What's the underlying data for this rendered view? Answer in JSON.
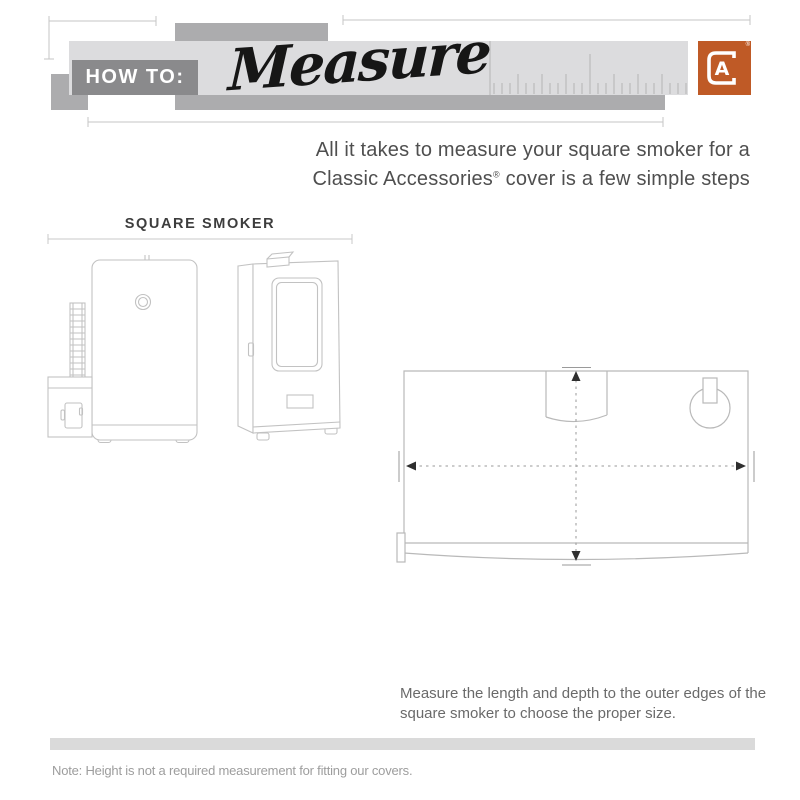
{
  "header": {
    "kicker": "HOW TO:",
    "title": "Measure",
    "logo_letter": "A",
    "registered_mark": "®"
  },
  "intro": {
    "line1": "All it takes to measure your square smoker for a",
    "line2_brand": "Classic Accessories",
    "line2_reg": "®",
    "line2_rest": " cover is a few simple steps"
  },
  "section": {
    "label": "SQUARE SMOKER"
  },
  "caption": {
    "line1": "Measure the length and depth to the outer edges of the",
    "line2": "square smoker to choose the proper size."
  },
  "footer": {
    "note": "Note: Height is not a required measurement for fitting our covers."
  },
  "colors": {
    "accent_orange": "#BF5A26",
    "band_light": "#DCDCDE",
    "band_mid": "#ACACAE",
    "badge_gray": "#8A8A8C",
    "measure_line_gray": "#C6C6C6",
    "drawing_line_gray": "#C2C2C2",
    "dash_gray": "#9A9A9A",
    "ink": "#161616"
  }
}
